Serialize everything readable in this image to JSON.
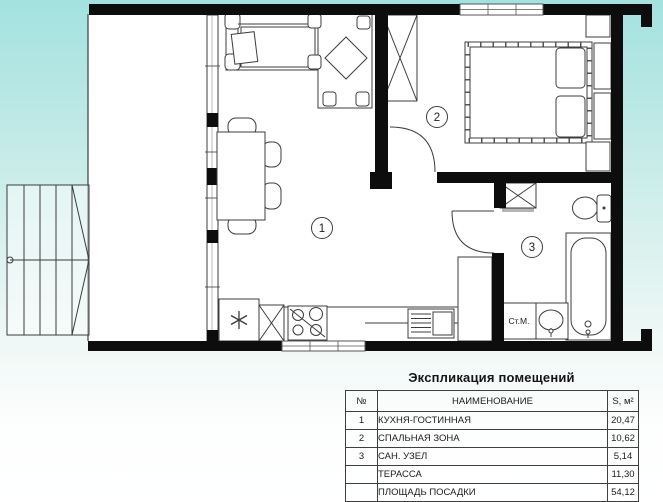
{
  "plan": {
    "rooms": [
      {
        "number": "1"
      },
      {
        "number": "2"
      },
      {
        "number": "3"
      }
    ],
    "washing_machine_label": "Ст.М.",
    "colors": {
      "wall": "#0d0d0d",
      "line": "#3c3c3c",
      "background_top": "#a3e2e0",
      "background_bottom": "#ffffff",
      "floor": "#ffffff"
    }
  },
  "table": {
    "title": "Экспликация помещений",
    "headers": {
      "num": "№",
      "name": "НАИМЕНОВАНИЕ",
      "area": "S, м²"
    },
    "rows": [
      {
        "num": "1",
        "name": "КУХНЯ-ГОСТИННАЯ",
        "area": "20,47"
      },
      {
        "num": "2",
        "name": "СПАЛЬНАЯ ЗОНА",
        "area": "10,62"
      },
      {
        "num": "3",
        "name": "САН. УЗЕЛ",
        "area": "5,14"
      },
      {
        "num": "",
        "name": "ТЕРАССА",
        "area": "11,30"
      },
      {
        "num": "",
        "name": "ПЛОЩАДЬ ПОСАДКИ",
        "area": "54,12"
      }
    ]
  }
}
